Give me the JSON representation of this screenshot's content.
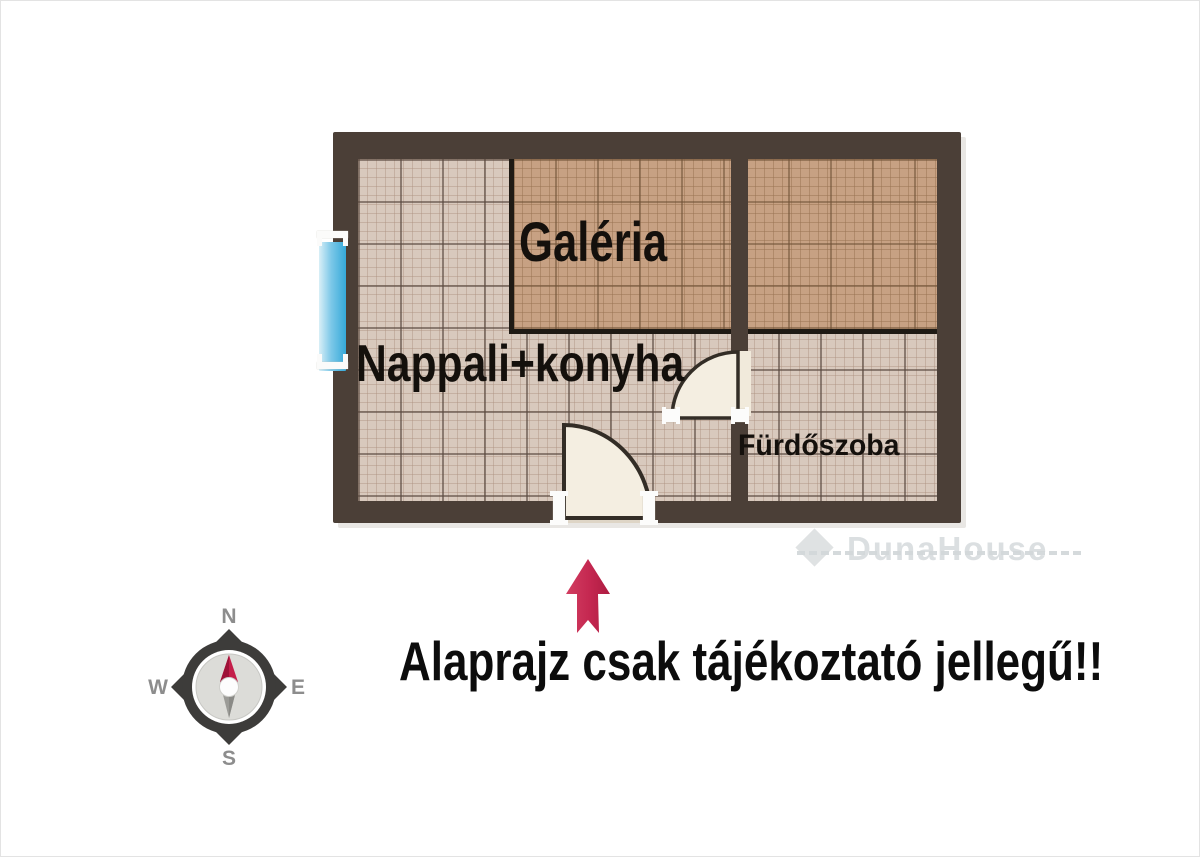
{
  "plan": {
    "rooms": {
      "galeria": {
        "label": "Galéria"
      },
      "nappali": {
        "label": "Nappali+konyha"
      },
      "furdoszoba": {
        "label": "Fürdőszoba"
      }
    },
    "watermark": {
      "text": "DunaHouse"
    },
    "disclaimer": {
      "text": "Alaprajz csak tájékoztató jellegű!!"
    },
    "compass": {
      "n": "N",
      "s": "S",
      "e": "E",
      "w": "W"
    },
    "colors": {
      "wall": "#4b3f37",
      "tile_light": "#d8c9bd",
      "tile_tan": "#c7a183",
      "window_blue": "#35a9d9",
      "door_fill": "#f4eee1",
      "arrow_red": "#c42750",
      "watermark_gray": "#c7cdd0"
    }
  }
}
